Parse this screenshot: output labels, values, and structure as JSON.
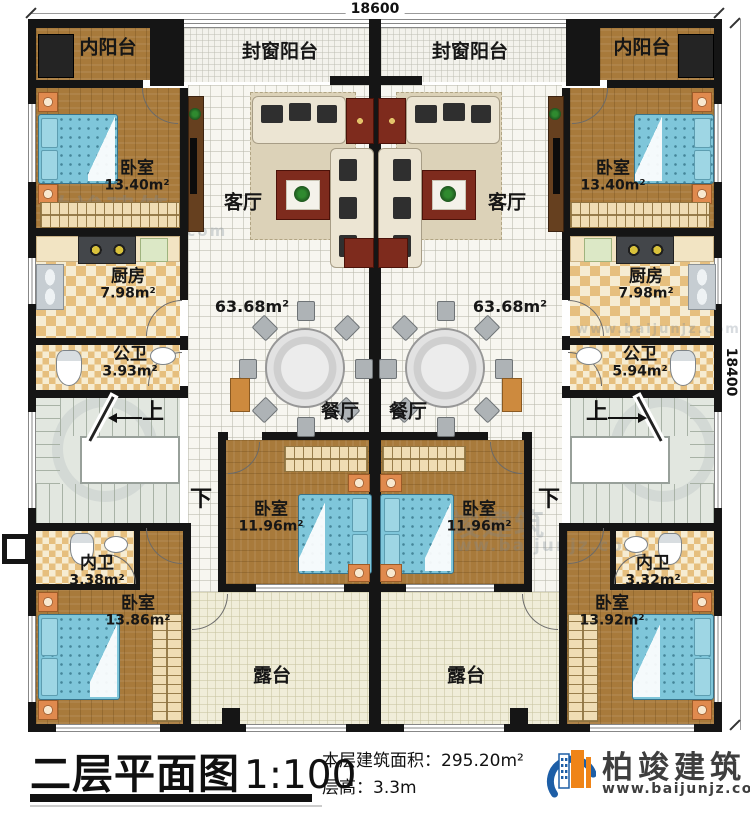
{
  "dimensions": {
    "top": "18600",
    "right": "18400"
  },
  "stairs": {
    "up": "上",
    "down": "下"
  },
  "rooms": {
    "balcony_inner": "内阳台",
    "balcony_sealed": "封窗阳台",
    "living": "客厅",
    "living_area": "63.68m²",
    "dining": "餐厅",
    "terrace": "露台",
    "bedroom": "卧室",
    "bedroom_top_area": "13.40m²",
    "bedroom_mid_area": "11.96m²",
    "bedroom_bottom_area_left": "13.86m²",
    "bedroom_bottom_area_right": "13.92m²",
    "kitchen": "厨房",
    "kitchen_area": "7.98m²",
    "bath_public": "公卫",
    "bath_public_area_left": "3.93m²",
    "bath_public_area_right": "5.94m²",
    "bath_inner": "内卫",
    "bath_inner_area_left": "3.38m²",
    "bath_inner_area_right": "3.32m²"
  },
  "watermark": {
    "brand": "柏竣建筑",
    "url": "www.baijunjz.com"
  },
  "footer": {
    "title": "二层平面图",
    "scale": "1:100",
    "area_label": "本层建筑面积：",
    "area_value": "295.20m²",
    "height_label": "层高：",
    "height_value": "3.3m",
    "brand": "柏竣建筑",
    "brand_url": "www.baijunjz.com"
  }
}
